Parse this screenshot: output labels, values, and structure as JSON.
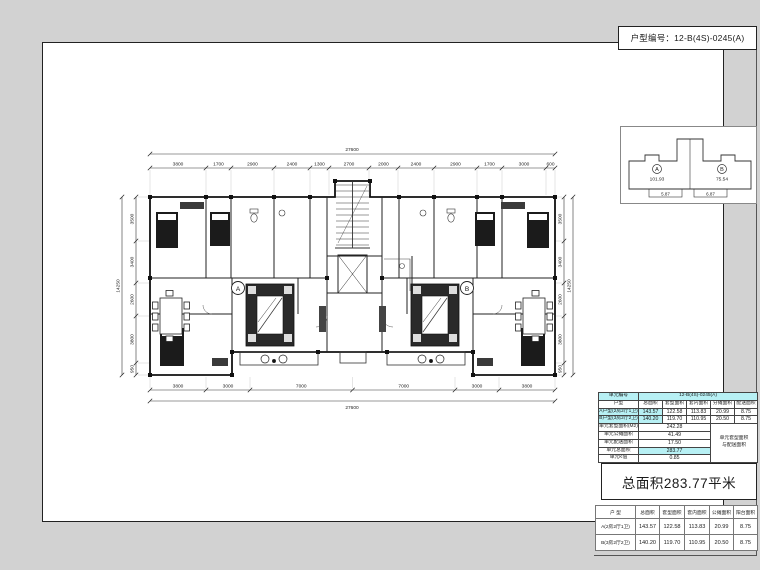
{
  "header": {
    "unit_code_label": "户型编号：",
    "unit_code_value": "12-B(4S)-0245(A)"
  },
  "key_plan": {
    "unit_a_label": "A",
    "unit_a_area": "101.93",
    "unit_b_label": "B",
    "unit_b_area": "75.54",
    "dim_left": "5.87",
    "dim_right": "6.87"
  },
  "unit_table": {
    "title_label": "单元编号",
    "title_value": "12-B(4S)-0245(A)",
    "columns": [
      "户型",
      "总面积",
      "套型面积",
      "套内面积",
      "分摊面积",
      "配送面积"
    ],
    "rows": [
      {
        "name": "A户型(2房2厅1卫)",
        "total": "143.57",
        "type": "122.58",
        "inner": "113.83",
        "share": "20.99",
        "bonus": "8.75"
      },
      {
        "name": "B户型(3房2厅2卫)",
        "total": "140.20",
        "type": "119.70",
        "inner": "110.95",
        "share": "20.50",
        "bonus": "8.75"
      }
    ],
    "summary": [
      {
        "label": "单元套型面积(M2)",
        "value": "242.28"
      },
      {
        "label": "单元公摊面积",
        "value": "41.49"
      },
      {
        "label": "单元配送面积",
        "value": "17.50"
      },
      {
        "label": "单元总面积",
        "value": "283.77"
      },
      {
        "label": "单元K值",
        "value": "0.85"
      }
    ],
    "note_line1": "单元套型面积",
    "note_line2": "与配送面积"
  },
  "total_area": {
    "text": "总面积283.77平米"
  },
  "bottom_table": {
    "columns": [
      "户 型",
      "总面积",
      "套型面积",
      "套内面积",
      "公摊面积",
      "阳台面积"
    ],
    "rows": [
      {
        "name": "A(2房2厅1卫)",
        "total": "143.57",
        "type": "122.58",
        "inner": "113.83",
        "share": "20.99",
        "balcony": "8.75"
      },
      {
        "name": "B(3房2厅2卫)",
        "total": "140.20",
        "type": "119.70",
        "inner": "110.95",
        "share": "20.50",
        "balcony": "8.75"
      }
    ]
  },
  "floor_plan": {
    "unit_a": "A",
    "unit_b": "B",
    "dims": {
      "top_overall": "27600",
      "top": [
        "3800",
        "1700",
        "2900",
        "2400",
        "1300",
        "2700",
        "2000",
        "2400",
        "2900",
        "1700",
        "3000",
        "600"
      ],
      "bottom": [
        "3800",
        "3000",
        "7000",
        "7000",
        "3000",
        "3800"
      ],
      "bottom_overall": "27600",
      "left": [
        "3500",
        "3400",
        "2600",
        "3800",
        "950"
      ],
      "left_overall": "14250",
      "right": [
        "3500",
        "3400",
        "2600",
        "3800",
        "950"
      ],
      "right_overall": "14250"
    }
  }
}
